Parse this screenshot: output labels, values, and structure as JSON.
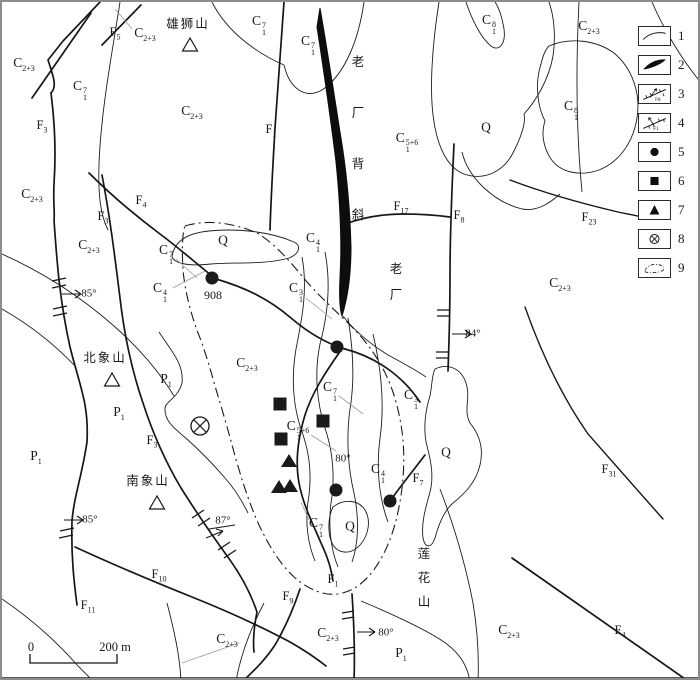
{
  "canvas": {
    "width": 700,
    "height": 680,
    "background": "#ffffff",
    "ink": "#1a1a1a",
    "frame": "#8c8c8c"
  },
  "legend": {
    "items": [
      {
        "num": "1",
        "symbol": "geological-boundary"
      },
      {
        "num": "2",
        "symbol": "ore-body"
      },
      {
        "num": "3",
        "symbol": "fault-f8",
        "text": "F8"
      },
      {
        "num": "4",
        "symbol": "fault-f1",
        "text": "F1"
      },
      {
        "num": "5",
        "symbol": "filled-circle-point"
      },
      {
        "num": "6",
        "symbol": "filled-square-point"
      },
      {
        "num": "7",
        "symbol": "filled-triangle-point"
      },
      {
        "num": "8",
        "symbol": "crossed-circle-shaft"
      },
      {
        "num": "9",
        "symbol": "dashdot-area-boundary"
      }
    ]
  },
  "scale_bar": {
    "start": "0",
    "end": "200 m"
  },
  "formation_labels": [
    {
      "x": 22,
      "y": 62,
      "base": "C",
      "sub": "2+3",
      "sup": ""
    },
    {
      "x": 78,
      "y": 88,
      "base": "C",
      "sub": "1",
      "sup": "7"
    },
    {
      "x": 143,
      "y": 32,
      "base": "C",
      "sub": "2+3",
      "sup": ""
    },
    {
      "x": 190,
      "y": 110,
      "base": "C",
      "sub": "2+3",
      "sup": ""
    },
    {
      "x": 257,
      "y": 23,
      "base": "C",
      "sub": "1",
      "sup": "7"
    },
    {
      "x": 306,
      "y": 43,
      "base": "C",
      "sub": "1",
      "sup": "7"
    },
    {
      "x": 405,
      "y": 140,
      "base": "C",
      "sub": "1",
      "sup": "5+6"
    },
    {
      "x": 487,
      "y": 22,
      "base": "C",
      "sub": "1",
      "sup": "8"
    },
    {
      "x": 587,
      "y": 25,
      "base": "C",
      "sub": "2+3",
      "sup": ""
    },
    {
      "x": 569,
      "y": 108,
      "base": "C",
      "sub": "1",
      "sup": "8"
    },
    {
      "x": 484,
      "y": 125,
      "base": "Q",
      "sub": "",
      "sup": ""
    },
    {
      "x": 30,
      "y": 193,
      "base": "C",
      "sub": "2+3",
      "sup": ""
    },
    {
      "x": 87,
      "y": 244,
      "base": "C",
      "sub": "2+3",
      "sup": ""
    },
    {
      "x": 221,
      "y": 238,
      "base": "Q",
      "sub": "",
      "sup": ""
    },
    {
      "x": 164,
      "y": 252,
      "base": "C",
      "sub": "1",
      "sup": "7"
    },
    {
      "x": 158,
      "y": 290,
      "base": "C",
      "sub": "1",
      "sup": "4"
    },
    {
      "x": 311,
      "y": 240,
      "base": "C",
      "sub": "1",
      "sup": "4"
    },
    {
      "x": 294,
      "y": 290,
      "base": "C",
      "sub": "1",
      "sup": "3"
    },
    {
      "x": 558,
      "y": 282,
      "base": "C",
      "sub": "2+3",
      "sup": ""
    },
    {
      "x": 245,
      "y": 362,
      "base": "C",
      "sub": "2+3",
      "sup": ""
    },
    {
      "x": 164,
      "y": 378,
      "base": "P",
      "sub": "1",
      "sup": ""
    },
    {
      "x": 117,
      "y": 411,
      "base": "P",
      "sub": "1",
      "sup": ""
    },
    {
      "x": 34,
      "y": 455,
      "base": "P",
      "sub": "1",
      "sup": ""
    },
    {
      "x": 328,
      "y": 389,
      "base": "C",
      "sub": "1",
      "sup": "7"
    },
    {
      "x": 409,
      "y": 397,
      "base": "C",
      "sub": "1",
      "sup": "3"
    },
    {
      "x": 296,
      "y": 428,
      "base": "C",
      "sub": "1",
      "sup": "5+6"
    },
    {
      "x": 376,
      "y": 471,
      "base": "C",
      "sub": "1",
      "sup": "4"
    },
    {
      "x": 444,
      "y": 450,
      "base": "Q",
      "sub": "",
      "sup": ""
    },
    {
      "x": 314,
      "y": 525,
      "base": "C",
      "sub": "1",
      "sup": "7"
    },
    {
      "x": 348,
      "y": 524,
      "base": "Q",
      "sub": "",
      "sup": ""
    },
    {
      "x": 225,
      "y": 638,
      "base": "C",
      "sub": "2+3",
      "sup": ""
    },
    {
      "x": 326,
      "y": 632,
      "base": "C",
      "sub": "2+3",
      "sup": ""
    },
    {
      "x": 399,
      "y": 652,
      "base": "P",
      "sub": "1",
      "sup": ""
    },
    {
      "x": 507,
      "y": 629,
      "base": "C",
      "sub": "2+3",
      "sup": ""
    }
  ],
  "fault_labels": [
    {
      "x": 40,
      "y": 124,
      "base": "F",
      "sub": "3"
    },
    {
      "x": 113,
      "y": 31,
      "base": "F",
      "sub": "5"
    },
    {
      "x": 269,
      "y": 128,
      "base": "F",
      "sub": "1"
    },
    {
      "x": 139,
      "y": 199,
      "base": "F",
      "sub": "4"
    },
    {
      "x": 101,
      "y": 215,
      "base": "F",
      "sub": "3"
    },
    {
      "x": 399,
      "y": 205,
      "base": "F",
      "sub": "17"
    },
    {
      "x": 457,
      "y": 214,
      "base": "F",
      "sub": "8"
    },
    {
      "x": 587,
      "y": 216,
      "base": "F",
      "sub": "23"
    },
    {
      "x": 150,
      "y": 439,
      "base": "F",
      "sub": "3"
    },
    {
      "x": 416,
      "y": 477,
      "base": "F",
      "sub": "7"
    },
    {
      "x": 331,
      "y": 578,
      "base": "F",
      "sub": "1"
    },
    {
      "x": 286,
      "y": 595,
      "base": "F",
      "sub": "9"
    },
    {
      "x": 157,
      "y": 573,
      "base": "F",
      "sub": "10"
    },
    {
      "x": 86,
      "y": 604,
      "base": "F",
      "sub": "11"
    },
    {
      "x": 607,
      "y": 468,
      "base": "F",
      "sub": "31"
    },
    {
      "x": 618,
      "y": 629,
      "base": "F",
      "sub": "4"
    }
  ],
  "place_labels": [
    {
      "text": "雄狮山",
      "x": 186,
      "y": 22,
      "orient": "h"
    },
    {
      "text": "北象山",
      "x": 103,
      "y": 356,
      "orient": "h"
    },
    {
      "text": "南象山",
      "x": 146,
      "y": 479,
      "orient": "h"
    },
    {
      "text": "老厂背斜",
      "x": 356,
      "y": 60,
      "orient": "v",
      "gap": 51
    },
    {
      "text": "老厂",
      "x": 394,
      "y": 267,
      "orient": "v",
      "gap": 26
    },
    {
      "text": "莲花山",
      "x": 422,
      "y": 552,
      "orient": "v",
      "gap": 24
    }
  ],
  "strike_angles": [
    {
      "text": "85°",
      "x": 87,
      "y": 292
    },
    {
      "text": "84°",
      "x": 471,
      "y": 332
    },
    {
      "text": "85°",
      "x": 88,
      "y": 518
    },
    {
      "text": "87°",
      "x": 221,
      "y": 519
    },
    {
      "text": "80°",
      "x": 341,
      "y": 457
    },
    {
      "text": "80°",
      "x": 384,
      "y": 631
    }
  ],
  "markers": {
    "circles": [
      {
        "x": 210,
        "y": 276,
        "label": "908"
      },
      {
        "x": 335,
        "y": 345,
        "label": ""
      },
      {
        "x": 334,
        "y": 488,
        "label": ""
      },
      {
        "x": 388,
        "y": 499,
        "label": ""
      }
    ],
    "squares": [
      {
        "x": 278,
        "y": 402
      },
      {
        "x": 321,
        "y": 419
      },
      {
        "x": 279,
        "y": 437
      }
    ],
    "triangles": [
      {
        "x": 287,
        "y": 459
      },
      {
        "x": 277,
        "y": 485
      },
      {
        "x": 288,
        "y": 484
      }
    ],
    "crossed_circles": [
      {
        "x": 198,
        "y": 424
      }
    ],
    "peaks": [
      {
        "x": 188,
        "y": 43
      },
      {
        "x": 110,
        "y": 378
      },
      {
        "x": 155,
        "y": 501
      }
    ]
  }
}
